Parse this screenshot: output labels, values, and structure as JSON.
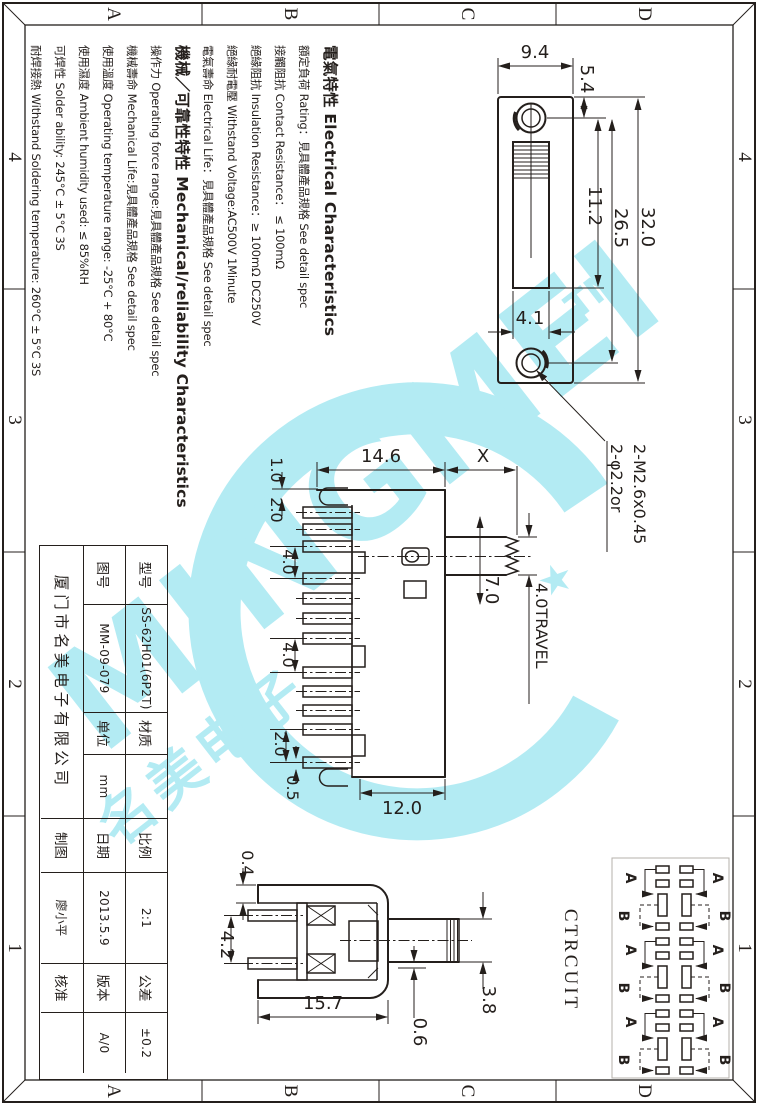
{
  "border": {
    "top": [
      "A",
      "B",
      "C",
      "D"
    ],
    "bottom": [
      "A",
      "B",
      "C",
      "D"
    ],
    "left": [
      "4",
      "3",
      "2",
      "1"
    ],
    "right": [
      "4",
      "3",
      "2",
      "1"
    ]
  },
  "specs": {
    "lines": [
      {
        "text": "電氣特性 Electrical Characteristics",
        "heading": true
      },
      {
        "text": "額定負荷 Rating：見具體產品規格 See detail spec",
        "heading": false
      },
      {
        "text": "接觸阻抗 Contact Resistance： ≤ 100mΩ",
        "heading": false
      },
      {
        "text": "絕緣阻抗 Insulation Resistance：≥ 100mΩ DC250V",
        "heading": false
      },
      {
        "text": "絕緣耐電壓 Withstand Voltage:AC500V 1Minute",
        "heading": false
      },
      {
        "text": "電氣壽命 Electrical Life：見具體產品規格 See detail spec",
        "heading": false
      },
      {
        "text": "機械／可靠性特性 Mechanical/reliability Characteristics",
        "heading": true
      },
      {
        "text": "操作力 Operating force range:見具體產品規格 See detail spec",
        "heading": false
      },
      {
        "text": "機械壽命 Mechanical Life:見具體產品規格 See detail spec",
        "heading": false
      },
      {
        "text": "使用溫度 Operating temperature range: -25°C + 80°C",
        "heading": false
      },
      {
        "text": "使用濕度 Ambient humidity used: ≤ 85%RH",
        "heading": false
      },
      {
        "text": "可焊性 Solder ability: 245°C ± 5°C  3S",
        "heading": false
      },
      {
        "text": "耐焊接熱 Withstand Soldering temperature: 260°C ± 5°C  3S",
        "heading": false
      }
    ]
  },
  "title_block": {
    "r1": [
      "型号",
      "SS-62H01(6P2T)",
      "材质",
      "",
      "比例",
      "2:1",
      "公差",
      "±0.2"
    ],
    "r2": [
      "图号",
      "MM-09-079",
      "单位",
      "mm",
      "日期",
      "2013.5.9",
      "版本",
      "A/0"
    ],
    "r3": [
      "厦门市名美电子有限公司",
      "制图",
      "廖小平",
      "核准",
      ""
    ]
  },
  "front": {
    "w": "9.4",
    "a": "5.4",
    "b": "11.2",
    "c": "26.5",
    "d": "32.0",
    "e": "4.1",
    "n1": "2-φ2.2or",
    "n2": "2-M2.6x0.45"
  },
  "side": {
    "w": "14.6",
    "x": "X",
    "d1": "1.0",
    "d2": "2.0",
    "d3": "4.0",
    "d4": "4.0",
    "d5": "2.0",
    "d6": "0.5",
    "d7": "7.0",
    "bw": "12.0",
    "travel": "4.0TRAVEL"
  },
  "section": {
    "d1": "0.4",
    "d2": "4.2",
    "d3": "15.7",
    "d4": "0.6",
    "d5": "3.8"
  },
  "circuit": {
    "label": "CTRCUIT",
    "a": "A",
    "b": "B"
  },
  "watermark": {
    "brand": "MINGMEI",
    "tm": "TM",
    "cn": "名美电子",
    "star": "★",
    "color": "#a6e8f2"
  }
}
